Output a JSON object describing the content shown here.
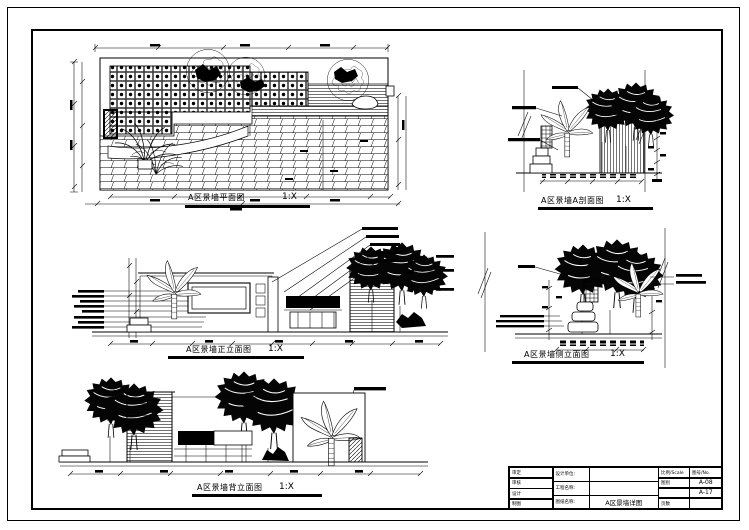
{
  "sheet": {
    "background": "#ffffff",
    "ink": "#000000"
  },
  "drawings": {
    "plan": {
      "title": "A区景墙平面图",
      "scale": "1:X"
    },
    "section": {
      "title": "A区景墙A剖面图",
      "scale": "1:X"
    },
    "front": {
      "title": "A区景墙正立面图",
      "scale": "1:X"
    },
    "side": {
      "title": "A区景墙侧立面图",
      "scale": "1:X"
    },
    "back": {
      "title": "A区景墙背立面图",
      "scale": "1:X"
    }
  },
  "title_block": {
    "sign_rows": [
      "审定",
      "审核",
      "设计",
      "制图"
    ],
    "info_labels": [
      "设计单位:",
      "工程名称:",
      "图纸名称:"
    ],
    "drawing_name": "A区景墙详图",
    "scale_header": "比例/Scale",
    "no_header": "图号/No.",
    "type_label": "图别",
    "pages_label": "页数",
    "sheet_no_1": "A-08",
    "sheet_no_2": "A-17"
  }
}
